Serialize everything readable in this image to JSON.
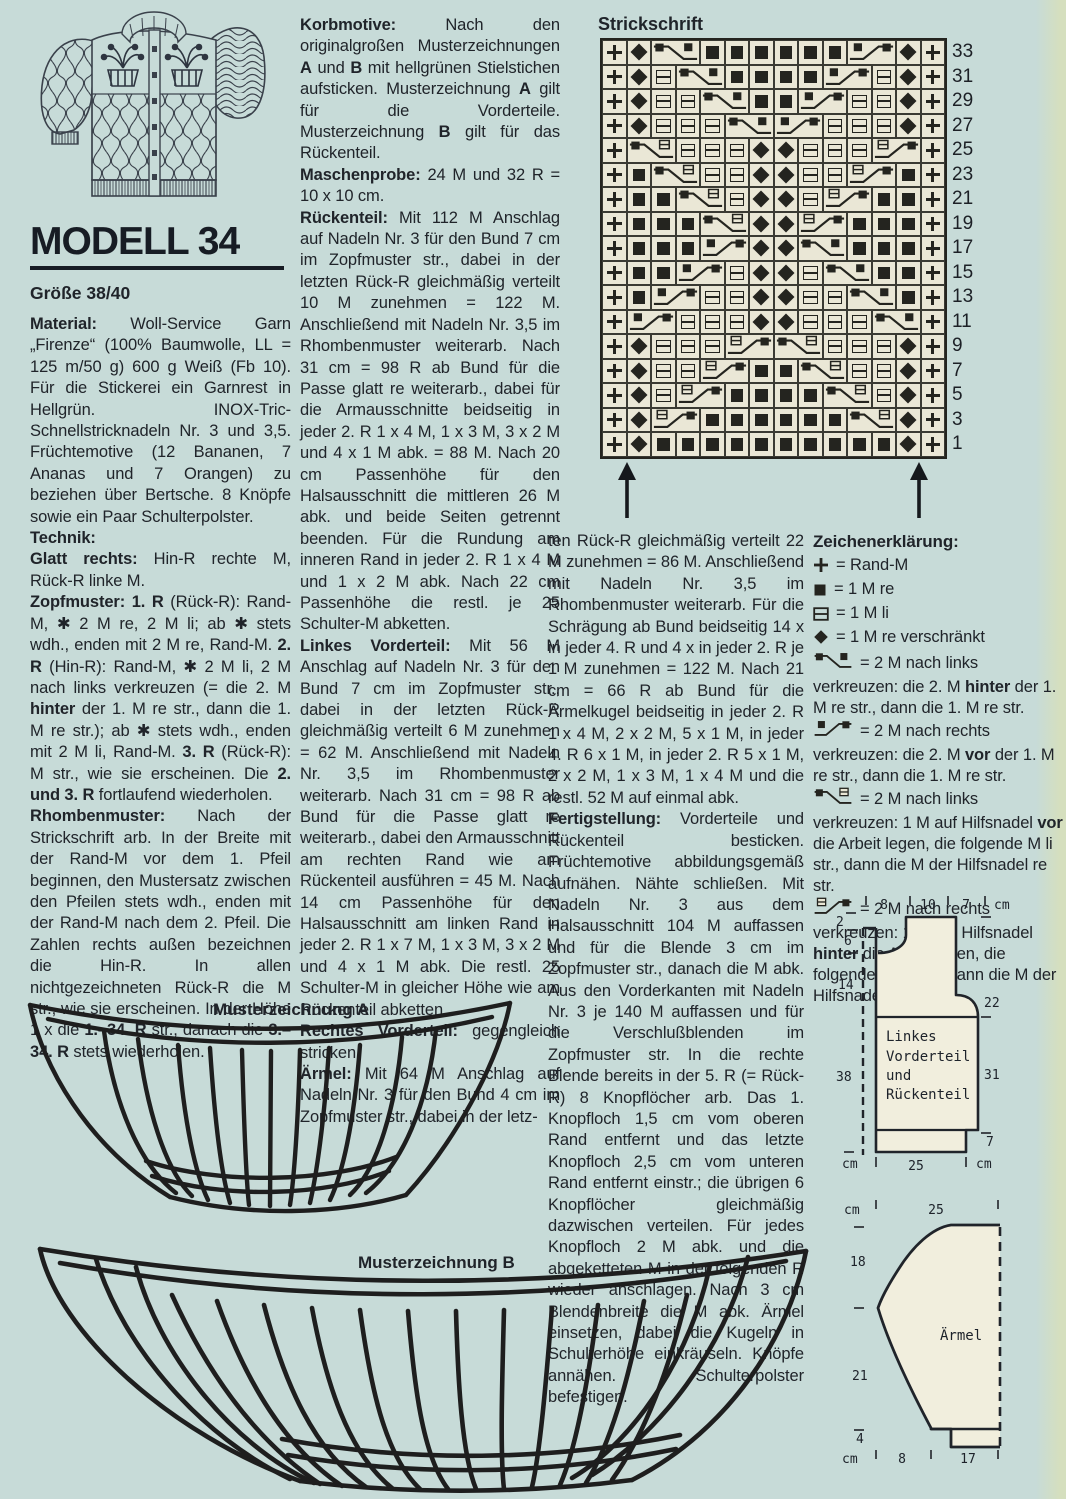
{
  "page": {
    "background": "#c7dbd8",
    "ink": "#20242a"
  },
  "header": {
    "model_title": "MODELL 34",
    "size": "Größe 38/40"
  },
  "left_column": {
    "paragraphs": [
      [
        {
          "b": 1,
          "t": "Material:"
        },
        {
          "t": " Woll-Service Garn „Firenze“ (100% Baumwolle, LL = 125 m/50 g) 600 g Weiß (Fb 10). Für die Stickerei ein Garnrest in Hellgrün. INOX-Tric-Schnellstricknadeln Nr. 3 und 3,5. Früchtemotive (12 Bananen, 7 Ananas und 7 Orangen) zu beziehen über Bertsche. 8 Knöpfe sowie ein Paar Schulterpolster."
        }
      ],
      [
        {
          "b": 1,
          "t": "Technik:"
        }
      ],
      [
        {
          "b": 1,
          "t": "Glatt rechts:"
        },
        {
          "t": " Hin-R rechte M, Rück-R linke M."
        }
      ],
      [
        {
          "b": 1,
          "t": "Zopfmuster: 1. R"
        },
        {
          "t": " (Rück-R): Rand-M, ✱ 2 M re, 2 M li; ab ✱ stets wdh., enden mit 2 M re, Rand-M. "
        },
        {
          "b": 1,
          "t": "2. R"
        },
        {
          "t": " (Hin-R): Rand-M, ✱ 2 M li, 2 M nach links verkreuzen (= die 2. M "
        },
        {
          "b": 1,
          "t": "hinter"
        },
        {
          "t": " der 1. M re str., dann die 1. M re str.); ab ✱ stets wdh., enden mit 2 M li, Rand-M. "
        },
        {
          "b": 1,
          "t": "3. R"
        },
        {
          "t": " (Rück-R): M str., wie sie erscheinen. Die "
        },
        {
          "b": 1,
          "t": "2. und 3. R"
        },
        {
          "t": " fortlaufend wiederholen."
        }
      ],
      [
        {
          "b": 1,
          "t": "Rhombenmuster:"
        },
        {
          "t": " Nach der Strickschrift arb. In der Breite mit der Rand-M vor dem 1. Pfeil beginnen, den Mustersatz zwischen den Pfeilen stets wdh., enden mit der Rand-M nach dem 2. Pfeil. Die Zahlen rechts außen bezeichnen die Hin-R. In allen nichtgezeichneten Rück-R die M str., wie sie erscheinen. In der Höhe 1 x die "
        },
        {
          "b": 1,
          "t": "1.–34. R"
        },
        {
          "t": " str., danach die "
        },
        {
          "b": 1,
          "t": "3.–34. R"
        },
        {
          "t": " stets wiederholen."
        }
      ]
    ]
  },
  "middle_column": {
    "paragraphs": [
      [
        {
          "b": 1,
          "t": "Korbmotive:"
        },
        {
          "t": " Nach den originalgroßen Musterzeichnungen "
        },
        {
          "b": 1,
          "t": "A"
        },
        {
          "t": " und "
        },
        {
          "b": 1,
          "t": "B"
        },
        {
          "t": " mit hellgrünen Stielstichen aufsticken. Musterzeichnung "
        },
        {
          "b": 1,
          "t": "A"
        },
        {
          "t": " gilt für die Vorderteile. Musterzeichnung "
        },
        {
          "b": 1,
          "t": "B"
        },
        {
          "t": " gilt für das Rückenteil."
        }
      ],
      [
        {
          "b": 1,
          "t": "Maschenprobe:"
        },
        {
          "t": " 24 M und 32 R = 10 x 10 cm."
        }
      ],
      [
        {
          "b": 1,
          "t": "Rückenteil:"
        },
        {
          "t": " Mit 112 M Anschlag auf Nadeln Nr. 3 für den Bund 7 cm im Zopfmuster str., dabei in der letzten Rück-R gleichmäßig verteilt 10 M zunehmen = 122 M. Anschließend mit Nadeln Nr. 3,5 im Rhombenmuster weiterarb. Nach 31 cm = 98 R ab Bund für die Passe glatt re weiterarb., dabei für die Armausschnitte beidseitig in jeder 2. R 1 x 4 M, 1 x 3 M, 3 x 2 M und 4 x 1 M abk. = 88 M. Nach 20 cm Passenhöhe für den Halsausschnitt die mittleren 26 M abk. und beide Seiten getrennt beenden. Für die Rundung am inneren Rand in jeder 2. R 1 x 4 M und 1 x 2 M abk. Nach 22 cm Passenhöhe die restl. je 25 Schulter-M abketten."
        }
      ],
      [
        {
          "b": 1,
          "t": "Linkes Vorderteil:"
        },
        {
          "t": " Mit 56 M Anschlag auf Nadeln Nr. 3 für den Bund 7 cm im Zopfmuster str., dabei in der letzten Rück-R gleichmäßig verteilt 6 M zunehmen = 62 M. Anschließend mit Nadeln Nr. 3,5 im Rhombenmuster weiterarb. Nach 31 cm = 98 R ab Bund für die Passe glatt re weiterarb., dabei den Armausschnitt am rechten Rand wie am Rückenteil ausführen = 45 M. Nach 14 cm Passenhöhe für den Halsausschnitt am linken Rand in jeder 2. R 1 x 7 M, 1 x 3 M, 3 x 2 M und 4 x 1 M abk. Die restl. 25 Schulter-M in gleicher Höhe wie am Rückenteil abketten."
        }
      ],
      [
        {
          "b": 1,
          "t": "Rechtes Vorderteil:"
        },
        {
          "t": " gegengleich stricken."
        }
      ],
      [
        {
          "b": 1,
          "t": "Ärmel:"
        },
        {
          "t": " Mit 64 M Anschlag auf Nadeln Nr. 3 für den Bund 4 cm im Zopfmuster str., dabei in der letz-"
        }
      ]
    ]
  },
  "third_column": {
    "paragraphs": [
      [
        {
          "t": "ten Rück-R gleichmäßig verteilt 22 M zunehmen = 86 M. Anschließend mit Nadeln Nr. 3,5 im Rhombenmuster weiterarb. Für die Schrägung ab Bund beidseitig 14 x in jeder 4. R und 4 x in jeder 2. R je 1 M zunehmen = 122 M. Nach 21 cm = 66 R ab Bund für die Ärmelkugel beidseitig in jeder 2. R 1 x 4 M, 2 x 2 M, 5 x 1 M, in jeder 4. R 6 x 1 M, in jeder 2. R 5 x 1 M, 2 x 2 M, 1 x 3 M, 1 x 4 M und die restl. 52 M auf einmal abk."
        }
      ],
      [
        {
          "b": 1,
          "t": "Fertigstellung:"
        },
        {
          "t": " Vorderteile und Rückenteil besticken. Früchtemotive abbildungsgemäß aufnähen. Nähte schließen. Mit Nadeln Nr. 3 aus dem Halsausschnitt 104 M auffassen und für die Blende 3 cm im Zopfmuster str., danach die M abk. Aus den Vorderkanten mit Nadeln Nr. 3 je 140 M auffassen und für die Verschlußblenden im Zopfmuster str. In die rechte Blende bereits in der 5. R (= Rück-R) 8 Knopflöcher arb. Das 1. Knopfloch 1,5 cm vom oberen Rand entfernt und das letzte Knopfloch 2,5 cm vom unteren Rand entfernt einstr.; die übrigen 6 Knopflöcher gleichmäßig dazwischen verteilen. Für jedes Knopfloch 2 M abk. und die abgeketteten M in der folgenden R wieder anschlagen. Nach 3 cm Blendenbreite die M abk. Ärmel einsetzen, dabei die Kugeln in Schulterhöhe einkräuseln. Knöpfe annähen. Schulterpolster befestigen."
        }
      ]
    ]
  },
  "chart": {
    "title": "Strickschrift",
    "columns": 14,
    "row_numbers": [
      "33",
      "31",
      "29",
      "27",
      "25",
      "23",
      "21",
      "19",
      "17",
      "15",
      "13",
      "11",
      "9",
      "7",
      "5",
      "3",
      "1"
    ],
    "symbol_key": {
      "r": "rand-stitch",
      "k": "knit-right",
      "p": "purl-left",
      "v": "knit-twisted",
      "Lkk": "cable-2-left",
      "Rkk": "cable-2-right",
      "Lkp": "cable-2-left-purl",
      "Rpk": "cable-2-right-purl"
    },
    "rows": [
      [
        "r",
        "v",
        "Lkk",
        "k",
        "k",
        "k",
        "k",
        "k",
        "k",
        "Rkk",
        "v",
        "r"
      ],
      [
        "r",
        "v",
        "p",
        "Lkk",
        "k",
        "k",
        "k",
        "k",
        "Rkk",
        "p",
        "v",
        "r"
      ],
      [
        "r",
        "v",
        "p",
        "p",
        "Lkk",
        "k",
        "k",
        "Rkk",
        "p",
        "p",
        "v",
        "r"
      ],
      [
        "r",
        "v",
        "p",
        "p",
        "p",
        "Lkk",
        "Rkk",
        "p",
        "p",
        "p",
        "v",
        "r"
      ],
      [
        "r",
        "Lkp",
        "p",
        "p",
        "p",
        "v",
        "v",
        "p",
        "p",
        "p",
        "Rpk",
        "r"
      ],
      [
        "r",
        "k",
        "Lkp",
        "p",
        "p",
        "v",
        "v",
        "p",
        "p",
        "Rpk",
        "k",
        "r"
      ],
      [
        "r",
        "k",
        "k",
        "Lkp",
        "p",
        "v",
        "v",
        "p",
        "Rpk",
        "k",
        "k",
        "r"
      ],
      [
        "r",
        "k",
        "k",
        "k",
        "Lkp",
        "v",
        "v",
        "Rpk",
        "k",
        "k",
        "k",
        "r"
      ],
      [
        "r",
        "k",
        "k",
        "k",
        "Rkk",
        "v",
        "v",
        "Lkk",
        "k",
        "k",
        "k",
        "r"
      ],
      [
        "r",
        "k",
        "k",
        "Rkk",
        "p",
        "v",
        "v",
        "p",
        "Lkk",
        "k",
        "k",
        "r"
      ],
      [
        "r",
        "k",
        "Rkk",
        "p",
        "p",
        "v",
        "v",
        "p",
        "p",
        "Lkk",
        "k",
        "r"
      ],
      [
        "r",
        "Rkk",
        "p",
        "p",
        "p",
        "v",
        "v",
        "p",
        "p",
        "p",
        "Lkk",
        "r"
      ],
      [
        "r",
        "v",
        "p",
        "p",
        "p",
        "Rpk",
        "Lkp",
        "p",
        "p",
        "p",
        "v",
        "r"
      ],
      [
        "r",
        "v",
        "p",
        "p",
        "Rpk",
        "k",
        "k",
        "Lkp",
        "p",
        "p",
        "v",
        "r"
      ],
      [
        "r",
        "v",
        "p",
        "Rpk",
        "k",
        "k",
        "k",
        "k",
        "Lkp",
        "p",
        "v",
        "r"
      ],
      [
        "r",
        "v",
        "Rpk",
        "k",
        "k",
        "k",
        "k",
        "k",
        "k",
        "Lkp",
        "v",
        "r"
      ],
      [
        "r",
        "v",
        "k",
        "k",
        "k",
        "k",
        "k",
        "k",
        "k",
        "k",
        "k",
        "k",
        "v",
        "r"
      ]
    ]
  },
  "legend": {
    "title": "Zeichenerklärung:",
    "items": [
      {
        "glyph": "rand",
        "segments": [
          {
            "t": "= Rand-M"
          }
        ]
      },
      {
        "glyph": "knit",
        "segments": [
          {
            "t": "= 1 M re"
          }
        ]
      },
      {
        "glyph": "purl",
        "segments": [
          {
            "t": "= 1 M li"
          }
        ]
      },
      {
        "glyph": "twist",
        "segments": [
          {
            "t": "= 1 M re verschränkt"
          }
        ]
      },
      {
        "glyph": "Lkk",
        "segments": [
          {
            "t": "= 2 M nach links verkreuzen: die 2. M "
          },
          {
            "b": 1,
            "t": "hinter"
          },
          {
            "t": " der 1. M re str., dann die 1. M re str."
          }
        ]
      },
      {
        "glyph": "Rkk",
        "segments": [
          {
            "t": "= 2 M nach rechts verkreuzen: die 2. M "
          },
          {
            "b": 1,
            "t": "vor"
          },
          {
            "t": " der 1. M re str., dann die 1. M re str."
          }
        ]
      },
      {
        "glyph": "Lkp",
        "segments": [
          {
            "t": "= 2 M nach links verkreuzen: 1 M auf Hilfsnadel "
          },
          {
            "b": 1,
            "t": "vor"
          },
          {
            "t": " die Arbeit legen, die folgende M li str., dann die M der Hilfsnadel re str."
          }
        ]
      },
      {
        "glyph": "Rpk",
        "segments": [
          {
            "t": "= 2 M nach rechts verkreuzen: 1 M auf Hilfsnadel "
          },
          {
            "b": 1,
            "t": "hinter"
          },
          {
            "t": " die Arbeit legen, die folgende M re str., dann die M der Hilfsnadel li str."
          }
        ]
      }
    ]
  },
  "drawing_a": {
    "title": "Musterzeichnung A"
  },
  "drawing_b": {
    "title": "Musterzeichnung B"
  },
  "schematic_front": {
    "labels": [
      "Linkes",
      "Vorderteil",
      "und",
      "Rückenteil"
    ],
    "top_ticks": [
      "8",
      "10",
      "7",
      "cm"
    ],
    "left_ticks": [
      "2",
      "6",
      "14",
      "38"
    ],
    "right_ticks": [
      "22",
      "31",
      "7"
    ],
    "bottom_ticks": [
      "cm",
      "25",
      "cm"
    ]
  },
  "schematic_sleeve": {
    "label": "Ärmel",
    "top_ticks": [
      "cm",
      "25"
    ],
    "left_ticks": [
      "18",
      "21",
      "4",
      "cm"
    ],
    "bottom_ticks": [
      "8",
      "17"
    ]
  }
}
